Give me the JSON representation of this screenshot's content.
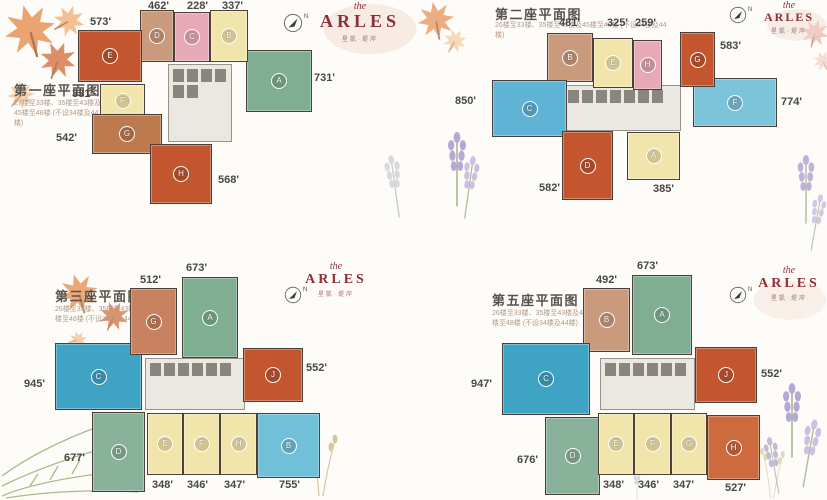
{
  "brand": {
    "pre": "the",
    "name": "ARLES",
    "sub": "星凱·堤岸",
    "color": "#8d3039"
  },
  "compass": {
    "label": "N"
  },
  "towers": [
    {
      "title": "第一座平面图",
      "note": "27楼至33楼、35楼至43楼及45楼至48楼 (不设34楼及44楼)",
      "units": [
        {
          "letter": "A",
          "area": "731'",
          "color": "#7fae93"
        },
        {
          "letter": "B",
          "area": "337'",
          "color": "#f2e5ab"
        },
        {
          "letter": "C",
          "area": "228'",
          "color": "#e8a9b6"
        },
        {
          "letter": "D",
          "area": "462'",
          "color": "#c99a7b"
        },
        {
          "letter": "E",
          "area": "573'",
          "color": "#c4562f"
        },
        {
          "letter": "F",
          "area": "331'",
          "color": "#f2e5ab"
        },
        {
          "letter": "G",
          "area": "542'",
          "color": "#bd7a4f"
        },
        {
          "letter": "H",
          "area": "568'",
          "color": "#c4562f"
        }
      ]
    },
    {
      "title": "第二座平面图",
      "note": "26楼至33楼、35楼至43楼及45楼至48楼 (不设34楼及44楼)",
      "units": [
        {
          "letter": "A",
          "area": "385'",
          "color": "#f2e5ab"
        },
        {
          "letter": "B",
          "area": "481'",
          "color": "#c99a7b"
        },
        {
          "letter": "C",
          "area": "850'",
          "color": "#5fb3d4"
        },
        {
          "letter": "D",
          "area": "582'",
          "color": "#c4562f"
        },
        {
          "letter": "E",
          "area": "325'",
          "color": "#f2e5ab"
        },
        {
          "letter": "F",
          "area": "774'",
          "color": "#7cc4da"
        },
        {
          "letter": "G",
          "area": "583'",
          "color": "#c4562f"
        },
        {
          "letter": "H",
          "area": "259'",
          "color": "#e8a9b6"
        }
      ]
    },
    {
      "title": "第三座平面图",
      "note": "26楼至33楼、35楼至43楼及45楼至48楼 (不设34楼及44楼)",
      "units": [
        {
          "letter": "A",
          "area": "673'",
          "color": "#7fae93"
        },
        {
          "letter": "B",
          "area": "755'",
          "color": "#6fc0d8"
        },
        {
          "letter": "C",
          "area": "945'",
          "color": "#3fa3c4"
        },
        {
          "letter": "D",
          "area": "677'",
          "color": "#8ab29b"
        },
        {
          "letter": "E",
          "area": "348'",
          "color": "#f2e5ab"
        },
        {
          "letter": "F",
          "area": "346'",
          "color": "#f2e5ab"
        },
        {
          "letter": "G",
          "area": "512'",
          "color": "#c8825f"
        },
        {
          "letter": "H",
          "area": "347'",
          "color": "#f2e5ab"
        },
        {
          "letter": "J",
          "area": "552'",
          "color": "#c4562f"
        }
      ]
    },
    {
      "title": "第五座平面图",
      "note": "26楼至33楼、35楼至43楼及45楼至48楼 (不设34楼及44楼)",
      "units": [
        {
          "letter": "A",
          "area": "673'",
          "color": "#7fae93"
        },
        {
          "letter": "B",
          "area": "492'",
          "color": "#c99a7b"
        },
        {
          "letter": "C",
          "area": "947'",
          "color": "#3fa3c4"
        },
        {
          "letter": "D",
          "area": "676'",
          "color": "#8ab29b"
        },
        {
          "letter": "E",
          "area": "348'",
          "color": "#f2e5ab"
        },
        {
          "letter": "F",
          "area": "346'",
          "color": "#f2e5ab"
        },
        {
          "letter": "G",
          "area": "347'",
          "color": "#f2e5ab"
        },
        {
          "letter": "H",
          "area": "527'",
          "color": "#cd6a3e"
        },
        {
          "letter": "J",
          "area": "552'",
          "color": "#c4562f"
        }
      ]
    }
  ]
}
